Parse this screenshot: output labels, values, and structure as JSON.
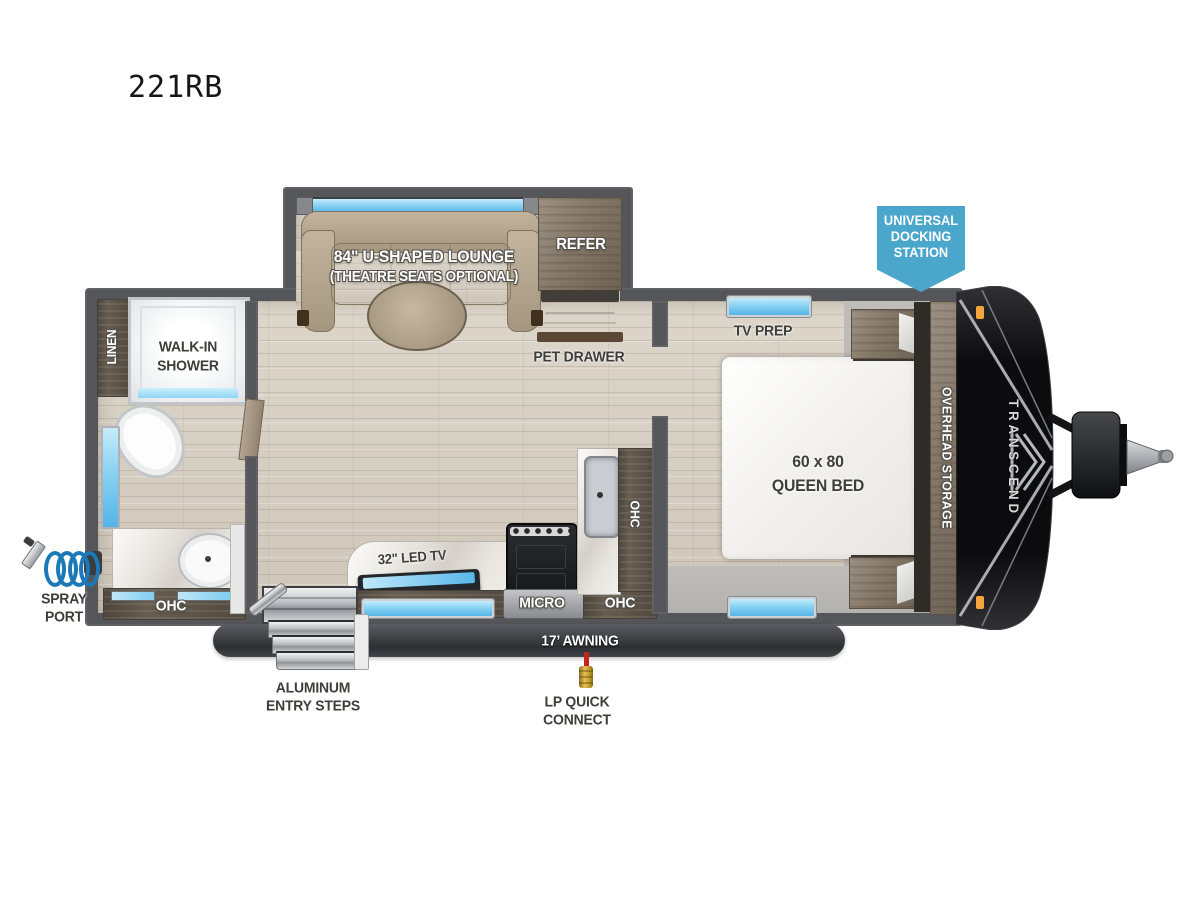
{
  "title": "221RB",
  "slideout": {
    "lounge_line1": "84\" U-SHAPED LOUNGE",
    "lounge_line2": "(THEATRE SEATS OPTIONAL)",
    "refer": "REFER"
  },
  "living": {
    "pet_drawer": "PET DRAWER"
  },
  "kitchen": {
    "led_tv": "32\" LED TV",
    "micro": "MICRO",
    "ohc_lower": "OHC",
    "ohc_side": "OHC"
  },
  "bathroom": {
    "linen": "LINEN",
    "shower_line1": "WALK-IN",
    "shower_line2": "SHOWER",
    "ohc": "OHC"
  },
  "bedroom": {
    "tv_prep": "TV PREP",
    "bed_line1": "60 x 80",
    "bed_line2": "QUEEN BED",
    "overhead_storage": "OVERHEAD STORAGE"
  },
  "front": {
    "brand": "TRANSCEND",
    "badge_line1": "UNIVERSAL",
    "badge_line2": "DOCKING",
    "badge_line3": "STATION"
  },
  "exterior": {
    "awning": "17’ AWNING",
    "spray_line1": "SPRAY",
    "spray_line2": "PORT",
    "steps_line1": "ALUMINUM",
    "steps_line2": "ENTRY STEPS",
    "lp_line1": "LP QUICK",
    "lp_line2": "CONNECT"
  },
  "colors": {
    "badge_blue": "#4ba6cb",
    "window_blue": "#6fc7ee",
    "wall_gray": "#55565a",
    "awning_gray": "#33363a",
    "wood_floor": "#d6cfc4",
    "cabinet_wood": "#675d50",
    "couch_tan": "#b3a58f",
    "marker_orange": "#f3a63c",
    "spray_blue": "#1a79b6",
    "lp_red": "#c4261f",
    "lp_brass": "#c9a227"
  }
}
